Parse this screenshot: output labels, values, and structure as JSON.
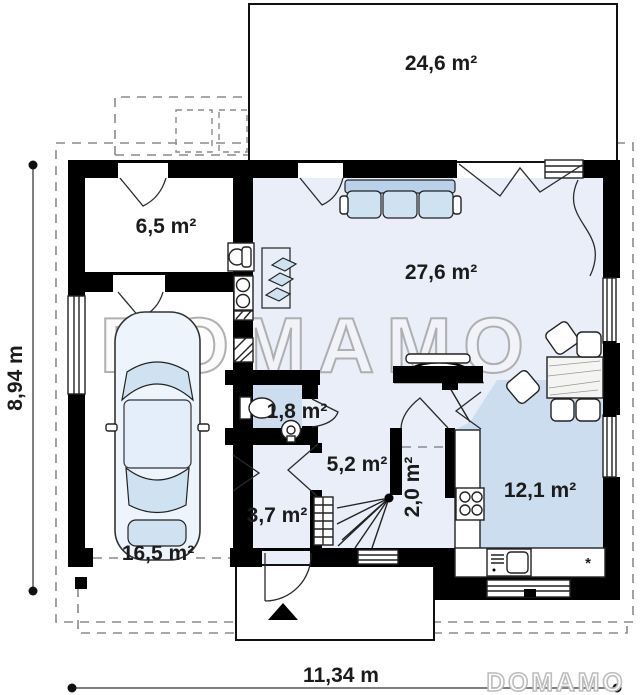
{
  "plan": {
    "type": "floor-plan",
    "watermark": "DOMAMO",
    "logo": "DOMAMO"
  },
  "rooms": {
    "terrace": {
      "area": "24,6 m²"
    },
    "tech": {
      "area": "6,5 m²"
    },
    "living": {
      "area": "27,6 m²"
    },
    "bath": {
      "area": "1,8 m²"
    },
    "hall": {
      "area": "5,2 m²"
    },
    "pantry": {
      "area": "2,0 m²"
    },
    "wardrobe": {
      "area": "3,7 m²"
    },
    "kitchen": {
      "area": "12,1 m²"
    },
    "garage": {
      "area": "16,5 m²"
    }
  },
  "dimensions": {
    "width": "11,34 m",
    "height": "8,94 m"
  },
  "kitchen": {
    "dishwasher_mark": "*"
  },
  "colors": {
    "wall": "#000000",
    "floor_light": "#e9eef8",
    "floor_dark": "#ccddef",
    "furniture_blue": "#cfe2f2",
    "dash_gray": "#8a8a8a"
  }
}
